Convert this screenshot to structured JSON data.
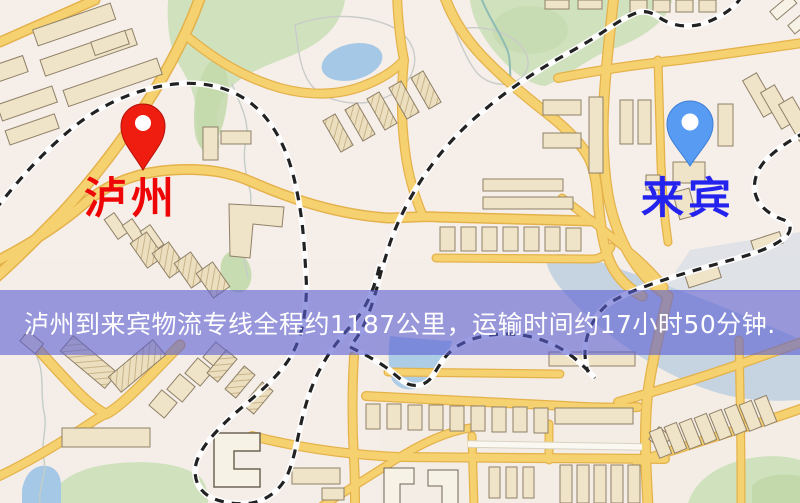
{
  "map": {
    "origin_marker": {
      "label": "泸州",
      "icon": "map-pin-icon",
      "pin_color": "#ee1d10",
      "label_color": "#ee0606"
    },
    "destination_marker": {
      "label": "来宾",
      "icon": "map-pin-icon",
      "pin_color": "#579bf3",
      "label_color": "#2423ee"
    },
    "banner": {
      "text": "泸州到来宾物流专线全程约1187公里，运输时间约17小时50分钟.",
      "background_color": "rgba(90,94,210,0.6)",
      "text_color": "#ffffff"
    },
    "theme": {
      "land_color": "#f5eee8",
      "road_color": "#f6d170",
      "park_color": "#cfe2bd",
      "water_color": "#a5c8e6",
      "railway_color": "#222222",
      "building_color": "#efe3c8"
    }
  }
}
